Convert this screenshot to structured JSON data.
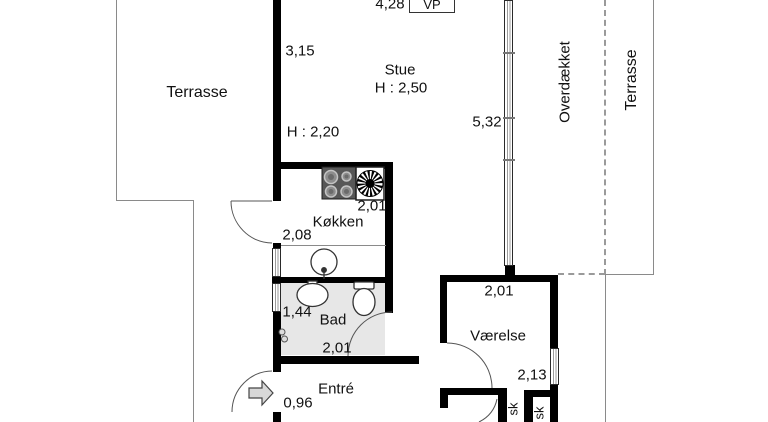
{
  "plan_title": "Floor plan (Danish)",
  "labels": {
    "terrasse_left": "Terrasse",
    "stue": "Stue",
    "stue_height": "H : 2,50",
    "door_height": "H : 2,20",
    "koekken": "Køkken",
    "bad": "Bad",
    "entre": "Entré",
    "vaerelse": "Værelse",
    "overdaekket": "Overdækket",
    "terrasse_right": "Terrasse",
    "vp": "VP",
    "closet1": "sk",
    "closet2": "sk"
  },
  "dims": {
    "stue_top_width": "4,28",
    "stue_left_height": "3,15",
    "glass_wall_length": "5,32",
    "koekken_width": "2,01",
    "koekken_left": "2,08",
    "bad_window": "1,44",
    "bad_width": "2,01",
    "entre_door": "0,96",
    "vaerelse_width": "2,01",
    "vaerelse_height": "2,13"
  },
  "colors": {
    "wall": "#000000",
    "bad_fill": "#e7e7e7",
    "thin_line": "#8a8a8a",
    "arrow_fill": "#d8d8d8",
    "fixture_stroke": "#333333"
  }
}
